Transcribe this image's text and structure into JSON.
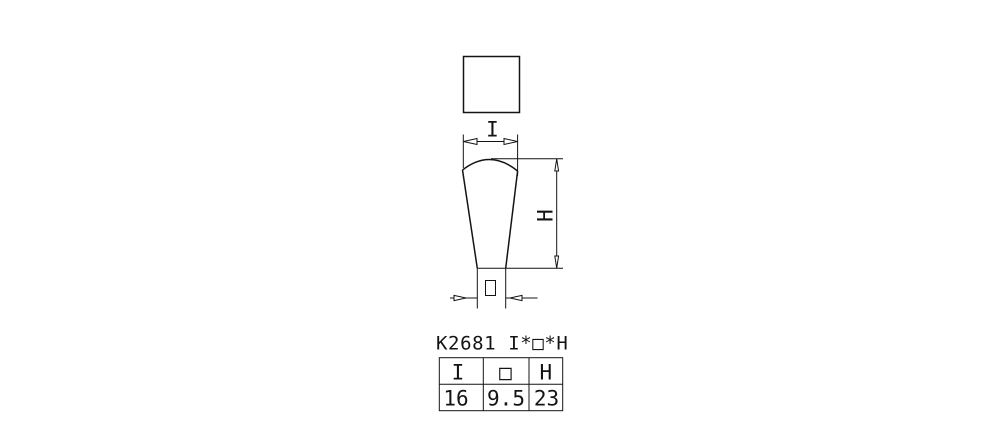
{
  "drawing": {
    "part_label": "K2681 I*□*H",
    "dim_width_label": "I",
    "dim_height_label": "H",
    "dim_square_label": "□"
  },
  "table": {
    "headers": [
      "I",
      "□",
      "H"
    ],
    "values": [
      "16",
      "9.5",
      "23"
    ]
  },
  "colors": {
    "line": "#141414",
    "background": "#ffffff"
  }
}
